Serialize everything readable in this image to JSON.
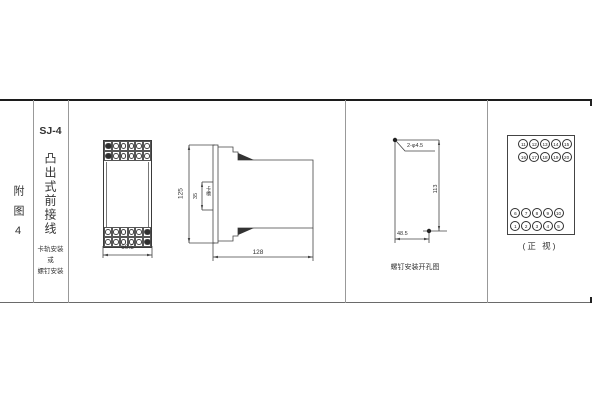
{
  "sheet": {
    "row_label": "附图4",
    "model": "SJ-4",
    "model_subtitle": "凸出式前接线",
    "mount_notes": [
      "卡轨安装",
      "或",
      "螺钉安装"
    ]
  },
  "front_view": {
    "width_dim": "60.5"
  },
  "side_view": {
    "height_dim": "125",
    "slot_dim": "35",
    "slot_label": "卡槽",
    "depth_dim": "128"
  },
  "drill_view": {
    "holes_label": "2-φ4.5",
    "height_dim": "113",
    "width_dim": "48.5",
    "caption": "螺钉安装开孔图"
  },
  "terminal_view": {
    "caption": "(正 视)",
    "rows": {
      "top1": [
        "11",
        "12",
        "13",
        "14",
        "15"
      ],
      "top2": [
        "16",
        "17",
        "18",
        "19",
        "20"
      ],
      "bottom1": [
        "6",
        "7",
        "8",
        "9",
        "10"
      ],
      "bottom2": [
        "1",
        "2",
        "3",
        "4",
        "5"
      ]
    }
  },
  "colors": {
    "line": "#444444",
    "frame_dark": "#1c1c1c",
    "background": "#ffffff"
  }
}
